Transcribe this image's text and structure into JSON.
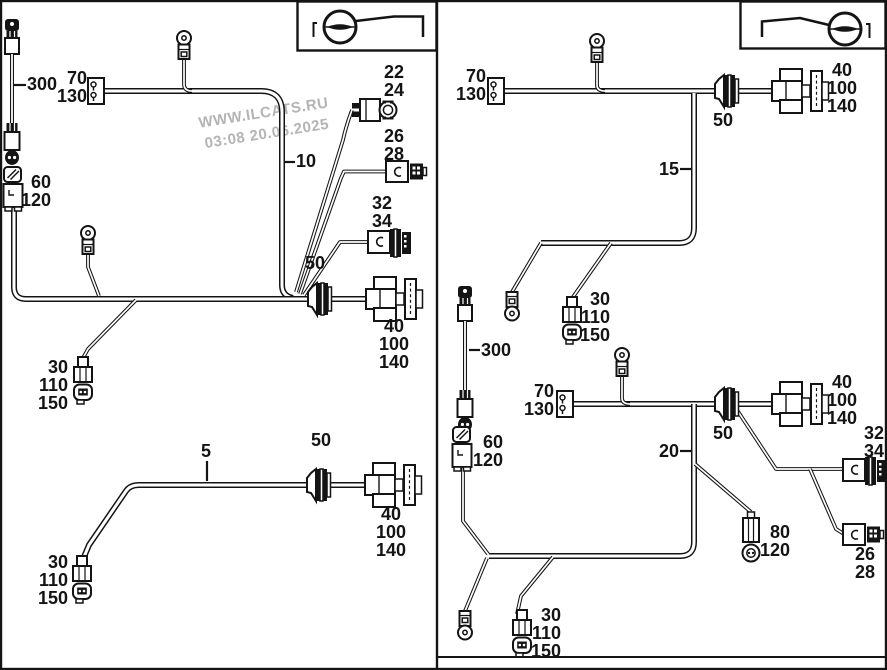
{
  "watermark": {
    "line1": "WWW.ILCATS.RU",
    "line2": "03:08 20.06.2025"
  },
  "colors": {
    "line": "#141414",
    "watermark": "#b4b4b4",
    "background": "#ffffff"
  },
  "icons": {
    "left_panel_symbol": "steering-wheel-left-drive-icon",
    "right_panel_symbol": "steering-wheel-right-drive-icon"
  },
  "left": {
    "c300": "300",
    "c70_130": [
      "70",
      "130"
    ],
    "c10": "10",
    "c22_24": [
      "22",
      "24"
    ],
    "c26_28": [
      "26",
      "28"
    ],
    "c32_34": [
      "32",
      "34"
    ],
    "c50_main": "50",
    "c40_main": [
      "40",
      "100",
      "140"
    ],
    "c60_120": [
      "60",
      "120"
    ],
    "c30_main": [
      "30",
      "110",
      "150"
    ],
    "c5": "5",
    "c50_low": "50",
    "c40_low": [
      "40",
      "100",
      "140"
    ],
    "c30_low": [
      "30",
      "110",
      "150"
    ]
  },
  "right": {
    "c70_130_top": [
      "70",
      "130"
    ],
    "c15": "15",
    "c50_top": "50",
    "c40_top": [
      "40",
      "100",
      "140"
    ],
    "c30_mid": [
      "30",
      "110",
      "150"
    ],
    "c300": "300",
    "c70_130_mid": [
      "70",
      "130"
    ],
    "c60_120": [
      "60",
      "120"
    ],
    "c20": "20",
    "c50_mid": "50",
    "c40_mid": [
      "40",
      "100",
      "140"
    ],
    "c32_34": [
      "32",
      "34"
    ],
    "c80_120": [
      "80",
      "120"
    ],
    "c26_28": [
      "26",
      "28"
    ],
    "c30_bot": [
      "30",
      "110",
      "150"
    ]
  }
}
